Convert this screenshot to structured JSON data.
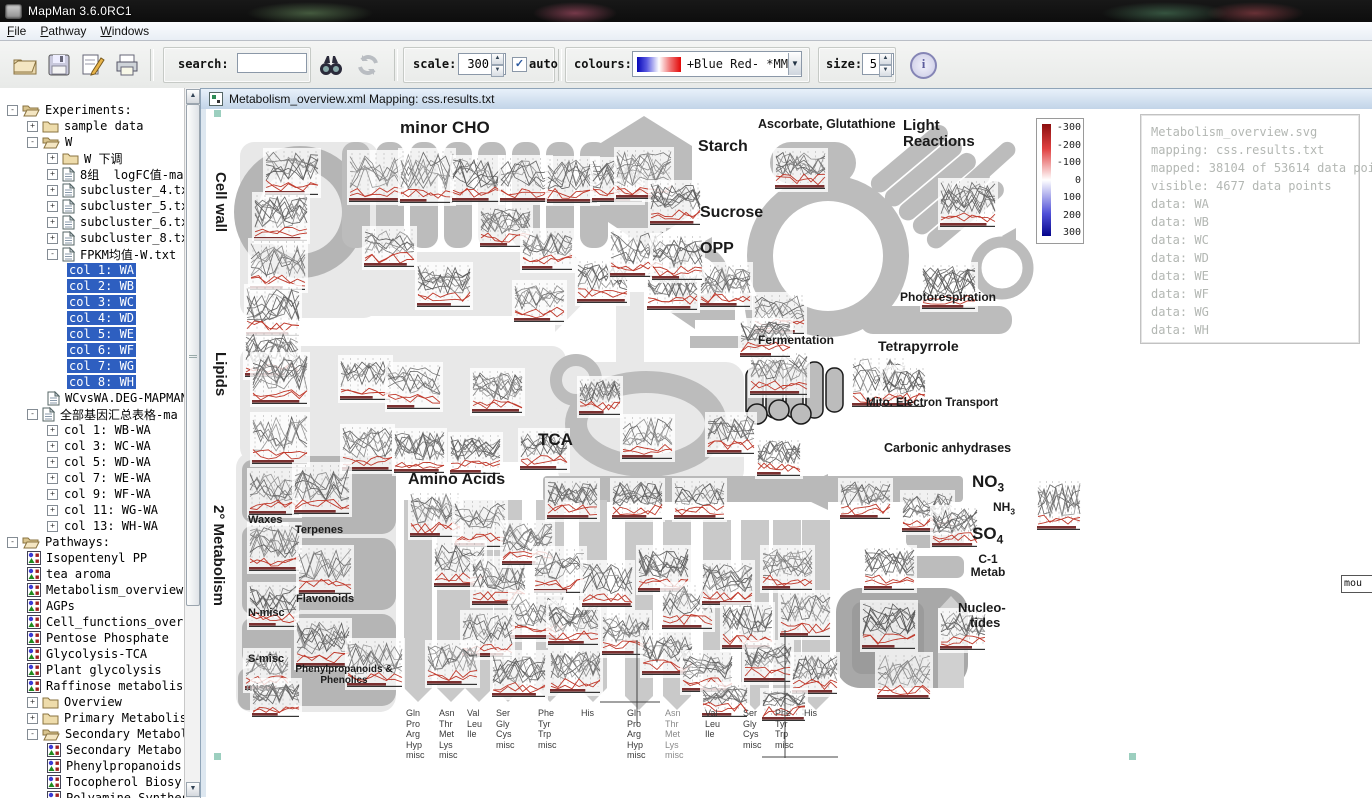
{
  "window": {
    "title": "MapMan 3.6.0RC1"
  },
  "menu": {
    "items": [
      "File",
      "Pathway",
      "Windows"
    ]
  },
  "toolbar": {
    "search_label": "search:",
    "search_value": "",
    "scale_label": "scale:",
    "scale_value": "300",
    "auto_label": "auto",
    "auto_checked": true,
    "colours_label": "colours:",
    "colours_value": "+Blue Red- *MM",
    "size_label": "size:",
    "size_value": "5"
  },
  "tree": {
    "items": [
      {
        "d": 0,
        "e": "-",
        "i": "folder-open",
        "t": "Experiments:"
      },
      {
        "d": 1,
        "e": "+",
        "i": "folder",
        "t": "sample data"
      },
      {
        "d": 1,
        "e": "-",
        "i": "folder-open",
        "t": "W"
      },
      {
        "d": 2,
        "e": "+",
        "i": "folder",
        "t": "W 下调"
      },
      {
        "d": 2,
        "e": "+",
        "i": "file",
        "t": "8组  logFC值-map"
      },
      {
        "d": 2,
        "e": "+",
        "i": "file",
        "t": "subcluster_4.txt"
      },
      {
        "d": 2,
        "e": "+",
        "i": "file",
        "t": "subcluster_5.txt"
      },
      {
        "d": 2,
        "e": "+",
        "i": "file",
        "t": "subcluster_6.txt"
      },
      {
        "d": 2,
        "e": "+",
        "i": "file",
        "t": "subcluster_8.txt"
      },
      {
        "d": 2,
        "e": "-",
        "i": "file",
        "t": "FPKM均值-W.txt"
      },
      {
        "d": 3,
        "t": "col 1: WA",
        "sel": true
      },
      {
        "d": 3,
        "t": "col 2: WB",
        "sel": true
      },
      {
        "d": 3,
        "t": "col 3: WC",
        "sel": true
      },
      {
        "d": 3,
        "t": "col 4: WD",
        "sel": true
      },
      {
        "d": 3,
        "t": "col 5: WE",
        "sel": true
      },
      {
        "d": 3,
        "t": "col 6: WF",
        "sel": true
      },
      {
        "d": 3,
        "t": "col 7: WG",
        "sel": true
      },
      {
        "d": 3,
        "t": "col 8: WH",
        "sel": true
      },
      {
        "d": 2,
        "i": "file",
        "t": "WCvsWA.DEG-MAPMAN.t"
      },
      {
        "d": 1,
        "e": "-",
        "i": "file",
        "t": "全部基因汇总表格-ma"
      },
      {
        "d": 2,
        "e": "+",
        "t": "col 1: WB-WA"
      },
      {
        "d": 2,
        "e": "+",
        "t": "col 3: WC-WA"
      },
      {
        "d": 2,
        "e": "+",
        "t": "col 5: WD-WA"
      },
      {
        "d": 2,
        "e": "+",
        "t": "col 7: WE-WA"
      },
      {
        "d": 2,
        "e": "+",
        "t": "col 9: WF-WA"
      },
      {
        "d": 2,
        "e": "+",
        "t": "col 11: WG-WA"
      },
      {
        "d": 2,
        "e": "+",
        "t": "col 13: WH-WA"
      },
      {
        "d": 0,
        "e": "-",
        "i": "folder-open",
        "t": "Pathways:"
      },
      {
        "d": 1,
        "i": "pathway",
        "t": "Isopentenyl PP"
      },
      {
        "d": 1,
        "i": "pathway",
        "t": "tea aroma"
      },
      {
        "d": 1,
        "i": "pathway",
        "t": "Metabolism_overview"
      },
      {
        "d": 1,
        "i": "pathway",
        "t": "AGPs"
      },
      {
        "d": 1,
        "i": "pathway",
        "t": "Cell_functions_over"
      },
      {
        "d": 1,
        "i": "pathway",
        "t": "Pentose Phosphate"
      },
      {
        "d": 1,
        "i": "pathway",
        "t": "Glycolysis-TCA"
      },
      {
        "d": 1,
        "i": "pathway",
        "t": "Plant glycolysis"
      },
      {
        "d": 1,
        "i": "pathway",
        "t": "Raffinose metabolis"
      },
      {
        "d": 1,
        "e": "+",
        "i": "folder",
        "t": "Overview"
      },
      {
        "d": 1,
        "e": "+",
        "i": "folder",
        "t": "Primary Metabolism"
      },
      {
        "d": 1,
        "e": "-",
        "i": "folder-open",
        "t": "Secondary Metabolis"
      },
      {
        "d": 2,
        "i": "pathway",
        "t": "Secondary Metabo"
      },
      {
        "d": 2,
        "i": "pathway",
        "t": "Phenylpropanoids"
      },
      {
        "d": 2,
        "i": "pathway",
        "t": "Tocopherol Biosy"
      },
      {
        "d": 2,
        "i": "pathway",
        "t": "Polyamine Synthes"
      }
    ]
  },
  "doc_window": {
    "title": "Metabolism_overview.xml Mapping: css.results.txt"
  },
  "legend": {
    "ticks": [
      "-300",
      "-200",
      "-100",
      "0",
      "100",
      "200",
      "300"
    ]
  },
  "info_panel": {
    "lines": [
      "Metabolism_overview.svg",
      "mapping: css.results.txt",
      "mapped: 38104 of 53614 data points",
      "visible: 4677 data points",
      "data: WA",
      "data: WB",
      "data: WC",
      "data: WD",
      "data: WE",
      "data: WF",
      "data: WG",
      "data: WH"
    ]
  },
  "tooltip": {
    "text": "mou"
  },
  "diagram": {
    "labels": {
      "minor_cho": "minor CHO",
      "cell_wall": "Cell wall",
      "lipids": "Lipids",
      "sec_metab": "2° Metabolism",
      "starch": "Starch",
      "sucrose": "Sucrose",
      "opp": "OPP",
      "ascorbate": "Ascorbate, Glutathione",
      "light_reactions": "Light Reactions",
      "photorespiration": "Photorespiration",
      "fermentation": "Fermentation",
      "tetrapyrrole": "Tetrapyrrole",
      "mito": "Mito. Electron Transport",
      "carbonic": "Carbonic anhydrases",
      "tca": "TCA",
      "amino_acids": "Amino Acids",
      "no3": "NO",
      "no3_sub": "3",
      "nh3": "NH",
      "nh3_sub": "3",
      "so4": "SO",
      "so4_sub": "4",
      "c1_line1": "C-1",
      "c1_line2": "Metab",
      "nucleo_line1": "Nucleo-",
      "nucleo_line2": "tides",
      "waxes": "Waxes",
      "terpenes": "Terpenes",
      "flavonoids": "Flavonoids",
      "n_misc": "N-misc",
      "s_misc": "S-misc",
      "phenylpropanoids": "Phenylpropanoids & Phenolics",
      "misc": "misc"
    },
    "aa_columns": [
      [
        "Gln",
        "Pro",
        "Arg",
        "Hyp",
        "misc"
      ],
      [
        "Asn",
        "Thr",
        "Met",
        "Lys",
        "misc"
      ],
      [
        "Val",
        "Leu",
        "Ile"
      ],
      [
        "Ser",
        "Gly",
        "Cys",
        "misc"
      ],
      [
        "Phe",
        "Tyr",
        "Trp",
        "misc"
      ],
      [
        "His"
      ]
    ]
  },
  "colors": {
    "selection": "#2e5fc0",
    "legend_top": "#8c0f0f",
    "legend_bottom": "#05058c",
    "shape_gray": "#bcbcbc",
    "handle_teal": "#9ccfbf"
  }
}
